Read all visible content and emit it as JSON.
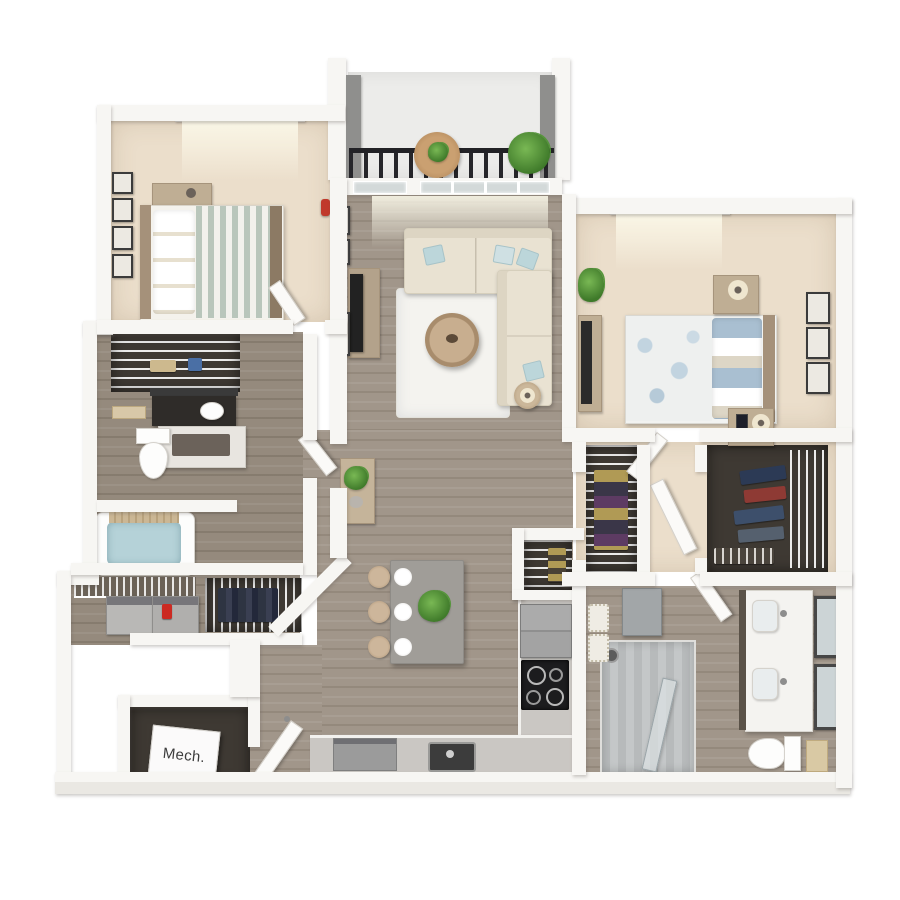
{
  "scene": {
    "description": "Photoreal 3D dollhouse-style floor plan render of a two-bedroom, two-bathroom apartment viewed from above on a white background",
    "visible_text": [
      "Mech."
    ]
  },
  "labels": {
    "mech_room": "Mech."
  },
  "rooms": [
    {
      "name": "balcony",
      "features": [
        "black metal railing",
        "round bistro table with plant",
        "potted plant"
      ]
    },
    {
      "name": "bedroom-1",
      "features": [
        "bed with white and striped sage duvet",
        "headboard dresser with clock",
        "gallery of wall frames",
        "window",
        "carpet floor"
      ]
    },
    {
      "name": "living-room",
      "features": [
        "L-shaped cream sectional with blue pillows",
        "round coffee table",
        "white area rug",
        "TV console with TV",
        "red vase",
        "wall frames",
        "glass balcony door and windows"
      ]
    },
    {
      "name": "bedroom-2",
      "features": [
        "bed with floral blue duvet",
        "two nightstands with lamps",
        "dresser with TV",
        "plant",
        "three wall frames",
        "window",
        "carpet floor"
      ]
    },
    {
      "name": "kitchen",
      "features": [
        "gray island with three stools and three place settings",
        "centerpiece plant",
        "pantry with wire shelving",
        "refrigerator",
        "black cooktop",
        "dishwasher",
        "sink"
      ]
    },
    {
      "name": "bathroom-1",
      "features": [
        "toilet",
        "dark-counter vanity with mirror",
        "towel rack",
        "bathtub with water and wood tray",
        "linen closet with wire shelving"
      ]
    },
    {
      "name": "laundry",
      "features": [
        "washer",
        "dryer",
        "red detergent bottle",
        "wire shelf",
        "angled coat closet with hanging clothes"
      ]
    },
    {
      "name": "mechanical-room",
      "features": [
        "white unit cube labeled Mech."
      ]
    },
    {
      "name": "entry",
      "features": [
        "open front door"
      ]
    },
    {
      "name": "hall-closet",
      "features": [
        "wire shelving",
        "hanging clothes"
      ]
    },
    {
      "name": "walk-in-closet",
      "features": [
        "wire shelving",
        "hanging clothes in navy, red and blue",
        "shoe shelf",
        "open door"
      ]
    },
    {
      "name": "bathroom-2",
      "features": [
        "walk-in tiled shower with glass door and shower head",
        "double vanity with two sinks and two framed mirrors",
        "toilet",
        "gray storage cabinet",
        "woven baskets",
        "bath mat"
      ]
    }
  ],
  "colors": {
    "background": "#ffffff",
    "walls": "#f7f6f3",
    "wood_floor": "#a1968a",
    "carpet": "#ebdecb",
    "bath_floor": "#958a7d",
    "closet_interior": "#3e3933",
    "railing_black": "#26262a",
    "sofa_cream": "#e9e2d2",
    "accent_pillow_blue": "#bcd6da",
    "island_gray": "#a09d98",
    "tub_water": "#b5d2d8",
    "plant_green": "#4e8f33",
    "cooktop_black": "#1c1c1e",
    "detergent_red": "#cc2a22",
    "wood_furniture_tan": "#bfae94"
  }
}
